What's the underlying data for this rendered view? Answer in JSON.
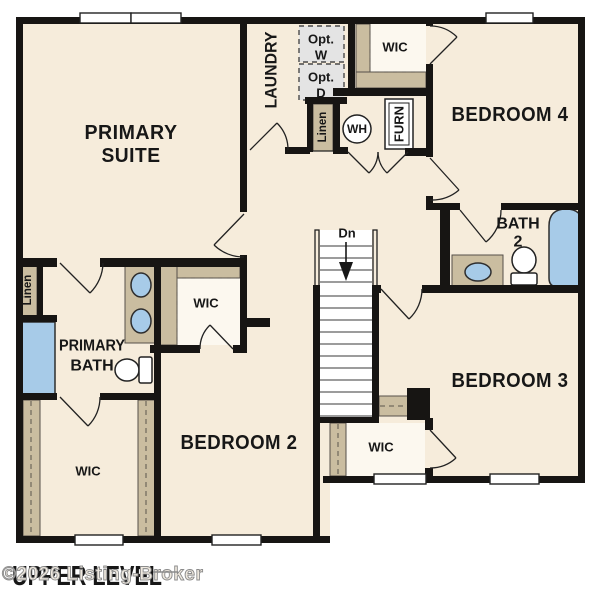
{
  "footer": {
    "title": "UPPER LEVEL",
    "watermark": "©2026 Listing-Broker"
  },
  "rooms": {
    "primary_suite": [
      "PRIMARY",
      "SUITE"
    ],
    "laundry": "LAUNDRY",
    "bedroom_4": "BEDROOM 4",
    "bedroom_3": "BEDROOM 3",
    "bedroom_2": "BEDROOM 2",
    "bath_2": [
      "BATH",
      "2"
    ],
    "primary_bath": [
      "PRIMARY",
      "BATH"
    ],
    "wic_top": "WIC",
    "wic_hall": "WIC",
    "wic_primary": "WIC",
    "wic_bedroom3": "WIC"
  },
  "closets": {
    "linen_hall": "Linen",
    "linen_bath": "Linen"
  },
  "equipment": {
    "water_heater": "WH",
    "furnace": "FURN",
    "optional_washer": [
      "Opt.",
      "W"
    ],
    "optional_dryer": [
      "Opt.",
      "D"
    ]
  },
  "stairs": {
    "direction": "Dn"
  },
  "colors": {
    "floor": "#f6ecdb",
    "closet_floor": "#fcf8ef",
    "wall": "#171513",
    "shelf_tan": "#cabda0",
    "optional_box_gray": "#e4e4e4",
    "fixture_blue": "#a7cbe8",
    "watermark_gray": "#8b8b8b"
  }
}
